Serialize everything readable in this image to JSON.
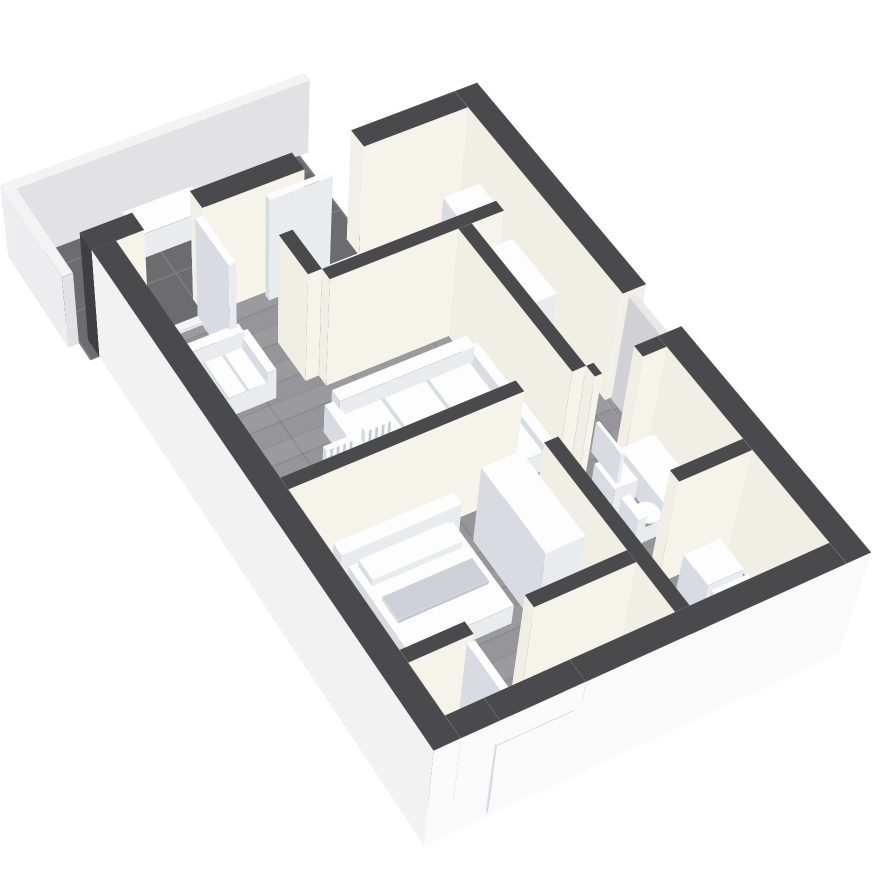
{
  "scene_label": "3D rendered apartment floor plan, tilted top-down view with dark walls, gray wood floors, tiled balcony and white furniture",
  "palette": {
    "background": "#ffffff",
    "wall_top": "#4a4a4d",
    "wall_inner": "#f6f3ea",
    "wall_inner_side": "#f1eee5",
    "wall_outer": "#fafafa",
    "wall_outer_side": "#ededee",
    "wood_floor": "#949497",
    "balcony_tile": "#6c6c6f",
    "furniture_top": "#fdfdfe",
    "furniture_front": "#e9ebef",
    "furniture_side": "#d8dbe1"
  },
  "plan": {
    "w": 440,
    "h": 670,
    "left": 88,
    "top": 340,
    "rotX": 34,
    "rotZ": -28,
    "perspective": 2600,
    "perspectiveOrigin": "256px 727px",
    "wallHeight": 150
  },
  "floors": [
    {
      "n": "balcony-tile-floor",
      "kind": "tile",
      "x": -10,
      "y": -130,
      "w": 322,
      "d": 156
    },
    {
      "n": "apartment-wood-floor",
      "kind": "wood",
      "x": 26,
      "y": 26,
      "w": 388,
      "d": 618
    },
    {
      "n": "entry-wood-patch",
      "kind": "wood",
      "x": 414,
      "y": 310,
      "w": 26,
      "d": 60
    }
  ],
  "boxes": [
    {
      "n": "outer-wall-top-left",
      "k": "wall",
      "x": 0,
      "y": 0,
      "w": 56,
      "d": 26,
      "h": 150,
      "wc": "#3f3f42"
    },
    {
      "n": "outer-wall-top-mid",
      "k": "wall",
      "x": 118,
      "y": 0,
      "w": 112,
      "d": 26,
      "h": 150,
      "wc": "#f0efe8"
    },
    {
      "n": "outer-wall-top-right",
      "k": "wall",
      "x": 296,
      "y": 0,
      "w": 118,
      "d": 26,
      "h": 150,
      "wc": "#f0efe8"
    },
    {
      "n": "outer-wall-right-upper",
      "k": "wall",
      "x": 414,
      "y": 0,
      "w": 26,
      "d": 310,
      "h": 150,
      "s": "#f0efe8"
    },
    {
      "n": "outer-wall-right-lower",
      "k": "wall",
      "x": 414,
      "y": 370,
      "w": 26,
      "d": 300,
      "h": 150,
      "s": "#fafafa"
    },
    {
      "n": "outer-wall-left",
      "k": "wall",
      "x": 0,
      "y": 26,
      "w": 26,
      "d": 644,
      "h": 150,
      "s": "#fafafa",
      "wc": "#f2f2f3"
    },
    {
      "n": "outer-wall-bottom-left",
      "k": "wall",
      "x": 26,
      "y": 644,
      "w": 38,
      "d": 26,
      "h": 150,
      "s": "#fafafa",
      "wc": "#ececee"
    },
    {
      "n": "outer-wall-bottom-right",
      "k": "wall",
      "x": 148,
      "y": 644,
      "w": 266,
      "d": 26,
      "h": 150,
      "s": "#fafafa",
      "wc": "#ececee"
    },
    {
      "n": "window-sill-wall",
      "k": "wall",
      "x": 64,
      "y": 644,
      "w": 84,
      "d": 26,
      "h": 15,
      "t": "#87878b",
      "s": "#fafafa",
      "wc": "#ececee"
    },
    {
      "n": "window-header-wall",
      "k": "wall",
      "x": 64,
      "y": 644,
      "w": 84,
      "d": 26,
      "h": 30,
      "z": 120,
      "s": "#fafafa",
      "wc": "#ececee"
    },
    {
      "n": "window-frame",
      "k": "furn",
      "x": 62,
      "y": 666,
      "w": 88,
      "d": 7,
      "h": 108,
      "z": 10,
      "t": "#fafafa",
      "s": "#fafafa"
    },
    {
      "n": "window-reveal",
      "k": "furn",
      "x": 70,
      "y": 664,
      "w": 72,
      "d": 8,
      "h": 92,
      "z": 18,
      "t": "#909094",
      "s": "#909094",
      "wc": "#808084"
    },
    {
      "n": "partition-kitchen-left",
      "k": "wall",
      "x": 166,
      "y": 92,
      "w": 15,
      "d": 58,
      "h": 150
    },
    {
      "n": "partition-kitchen-bottom",
      "k": "wall",
      "x": 181,
      "y": 150,
      "w": 191,
      "d": 15,
      "h": 150
    },
    {
      "n": "partition-corridor",
      "k": "wall",
      "x": 321,
      "y": 165,
      "w": 15,
      "d": 205,
      "h": 150
    },
    {
      "n": "partition-bedroom-top",
      "k": "wall",
      "x": 26,
      "y": 355,
      "w": 244,
      "d": 15,
      "h": 150
    },
    {
      "n": "partition-bedroom-right",
      "k": "wall",
      "x": 254,
      "y": 430,
      "w": 15,
      "d": 214,
      "h": 150
    },
    {
      "n": "partition-bath-top-a",
      "k": "wall",
      "x": 336,
      "y": 370,
      "w": 8,
      "d": 15,
      "h": 150
    },
    {
      "n": "partition-bath-top-b",
      "k": "wall",
      "x": 388,
      "y": 370,
      "w": 26,
      "d": 15,
      "h": 150
    },
    {
      "n": "partition-bath-bottom",
      "k": "wall",
      "x": 336,
      "y": 510,
      "w": 78,
      "d": 15,
      "h": 150
    },
    {
      "n": "partition-closet-a",
      "k": "wall",
      "x": 26,
      "y": 568,
      "w": 64,
      "d": 15,
      "h": 150
    },
    {
      "n": "partition-closet-b",
      "k": "wall",
      "x": 150,
      "y": 568,
      "w": 104,
      "d": 15,
      "h": 150
    },
    {
      "n": "balcony-parapet-top",
      "k": "par",
      "x": -22,
      "y": -142,
      "w": 344,
      "d": 12,
      "h": 100
    },
    {
      "n": "balcony-parapet-left",
      "k": "par",
      "x": -22,
      "y": -130,
      "w": 12,
      "d": 130,
      "h": 100
    },
    {
      "n": "balcony-table",
      "k": "furn",
      "x": 95,
      "y": -112,
      "w": 80,
      "d": 38,
      "h": 34
    },
    {
      "n": "balcony-door-threshold",
      "k": "furn",
      "x": 56,
      "y": 26,
      "w": 62,
      "d": 10,
      "h": 4,
      "t": "#f5f5f6"
    },
    {
      "n": "kitchen-door-threshold",
      "k": "furn",
      "x": 230,
      "y": 26,
      "w": 66,
      "d": 10,
      "h": 4,
      "t": "#f5f5f6"
    },
    {
      "n": "balcony-door-leaf",
      "k": "furn",
      "x": 110,
      "y": 26,
      "w": 8,
      "d": 70,
      "h": 140
    },
    {
      "n": "kitchen-door-leaf",
      "k": "furn",
      "x": 185,
      "y": 30,
      "w": 70,
      "d": 8,
      "h": 140
    },
    {
      "n": "closet-door-leaf",
      "k": "furn",
      "x": 84,
      "y": 583,
      "w": 8,
      "d": 64,
      "h": 140
    },
    {
      "n": "entry-door-panel",
      "k": "furn",
      "x": 420,
      "y": 312,
      "w": 8,
      "d": 56,
      "h": 145,
      "t": "#e8e8eb",
      "s": "#dcdce0",
      "wc": "#d0d0d5"
    },
    {
      "n": "entry-step",
      "k": "furn",
      "x": 440,
      "y": 305,
      "w": 20,
      "d": 64,
      "h": 8,
      "t": "#dddde0",
      "s": "#cfcfd2",
      "wc": "#c8c8cb"
    },
    {
      "n": "armchair-seat",
      "k": "furn",
      "x": 56,
      "y": 100,
      "w": 66,
      "d": 56,
      "h": 28,
      "bgt": "repeating-linear-gradient(90deg,#fdfdfe 0 19px,#d9dce2 19px 22px)"
    },
    {
      "n": "armchair-back",
      "k": "furn",
      "x": 56,
      "y": 92,
      "w": 66,
      "d": 12,
      "h": 50
    },
    {
      "n": "armchair-arm-left",
      "k": "furn",
      "x": 48,
      "y": 96,
      "w": 10,
      "d": 60,
      "h": 42
    },
    {
      "n": "armchair-arm-right",
      "k": "furn",
      "x": 120,
      "y": 96,
      "w": 10,
      "d": 60,
      "h": 42
    },
    {
      "n": "sofa-back",
      "k": "furn",
      "x": 160,
      "y": 212,
      "w": 150,
      "d": 16,
      "h": 52
    },
    {
      "n": "sofa-seat",
      "k": "furn",
      "x": 160,
      "y": 228,
      "w": 150,
      "d": 66,
      "h": 30,
      "bgt": "repeating-linear-gradient(90deg,#fdfdfe 0 46px,#d9dce2 46px 50px)"
    },
    {
      "n": "sofa-chaise",
      "k": "furn",
      "x": 262,
      "y": 294,
      "w": 48,
      "d": 64,
      "h": 30
    },
    {
      "n": "sofa-arm-left",
      "k": "furn",
      "x": 150,
      "y": 216,
      "w": 12,
      "d": 78,
      "h": 40
    },
    {
      "n": "sofa-arm-right",
      "k": "furn",
      "x": 310,
      "y": 216,
      "w": 12,
      "d": 142,
      "h": 40
    },
    {
      "n": "coffee-table",
      "k": "furn",
      "x": 66,
      "y": 298,
      "w": 104,
      "d": 54,
      "h": 26
    },
    {
      "n": "sideboard-left-wall",
      "k": "furn",
      "x": 30,
      "y": 430,
      "w": 8,
      "d": 60,
      "h": 8
    },
    {
      "n": "dining-table",
      "k": "furn",
      "x": 95,
      "y": 310,
      "w": 120,
      "d": 42,
      "h": 36
    },
    {
      "n": "dining-chair-1-seat",
      "k": "furn",
      "x": 116,
      "y": 280,
      "w": 30,
      "d": 28,
      "h": 26
    },
    {
      "n": "dining-chair-1-back",
      "k": "furn",
      "x": 116,
      "y": 274,
      "w": 30,
      "d": 7,
      "h": 58,
      "bgs": "repeating-linear-gradient(90deg,#fdfdfe 0 4px,#c6cad0 4px 7px)"
    },
    {
      "n": "dining-chair-2-seat",
      "k": "furn",
      "x": 160,
      "y": 276,
      "w": 30,
      "d": 28,
      "h": 26
    },
    {
      "n": "dining-chair-2-back",
      "k": "furn",
      "x": 160,
      "y": 270,
      "w": 30,
      "d": 7,
      "h": 58,
      "bgs": "repeating-linear-gradient(90deg,#fdfdfe 0 4px,#c6cad0 4px 7px)"
    },
    {
      "n": "dining-chair-3-seat",
      "k": "furn",
      "x": 60,
      "y": 316,
      "w": 28,
      "d": 30,
      "h": 26
    },
    {
      "n": "dining-chair-3-back",
      "k": "furn",
      "x": 53,
      "y": 316,
      "w": 7,
      "d": 30,
      "h": 58
    },
    {
      "n": "bed-headboard",
      "k": "furn",
      "x": 72,
      "y": 374,
      "w": 128,
      "d": 16,
      "h": 50
    },
    {
      "n": "bed-mattress",
      "k": "furn",
      "x": 80,
      "y": 390,
      "w": 112,
      "d": 110,
      "h": 28
    },
    {
      "n": "bed-pillow",
      "k": "furn",
      "x": 88,
      "y": 394,
      "w": 96,
      "d": 26,
      "h": 10,
      "z": 28
    },
    {
      "n": "bed-blanket",
      "k": "furn",
      "x": 88,
      "y": 438,
      "w": 96,
      "d": 30,
      "h": 5,
      "z": 28,
      "t": "#cdd1d7",
      "s": "#c3c7cd"
    },
    {
      "n": "bedroom-wardrobe",
      "k": "furn",
      "x": 210,
      "y": 400,
      "w": 42,
      "d": 112,
      "h": 108
    },
    {
      "n": "hall-wardrobe",
      "k": "furn",
      "x": 340,
      "y": 170,
      "w": 42,
      "d": 82,
      "h": 112
    },
    {
      "n": "fridge",
      "k": "furn",
      "x": 364,
      "y": 70,
      "w": 42,
      "d": 48,
      "h": 88
    },
    {
      "n": "bathroom-sink",
      "k": "furn",
      "x": 340,
      "y": 400,
      "w": 26,
      "d": 36,
      "h": 40
    },
    {
      "n": "bathroom-mirror",
      "k": "furn",
      "x": 337,
      "y": 396,
      "w": 4,
      "d": 44,
      "h": 42,
      "z": 55
    },
    {
      "n": "toilet-tank",
      "k": "furn",
      "x": 339,
      "y": 448,
      "w": 10,
      "d": 30,
      "h": 42
    },
    {
      "n": "toilet-bowl",
      "k": "furn",
      "x": 349,
      "y": 450,
      "w": 24,
      "d": 27,
      "h": 24,
      "r": 12
    },
    {
      "n": "bathtub",
      "k": "furn",
      "x": 374,
      "y": 393,
      "w": 38,
      "d": 112,
      "h": 36
    },
    {
      "n": "bathtub-inner",
      "k": "furn",
      "x": 379,
      "y": 398,
      "w": 28,
      "d": 100,
      "h": 30,
      "z": 2,
      "t": "#ebedf0",
      "s": "#e0e2e6"
    },
    {
      "n": "storage-washer",
      "k": "furn",
      "x": 348,
      "y": 538,
      "w": 40,
      "d": 40,
      "h": 52
    },
    {
      "n": "storage-box",
      "k": "furn",
      "x": 348,
      "y": 584,
      "w": 40,
      "d": 38,
      "h": 52
    },
    {
      "n": "hall-cabinet",
      "k": "furn",
      "x": 278,
      "y": 588,
      "w": 32,
      "d": 36,
      "h": 42
    }
  ]
}
